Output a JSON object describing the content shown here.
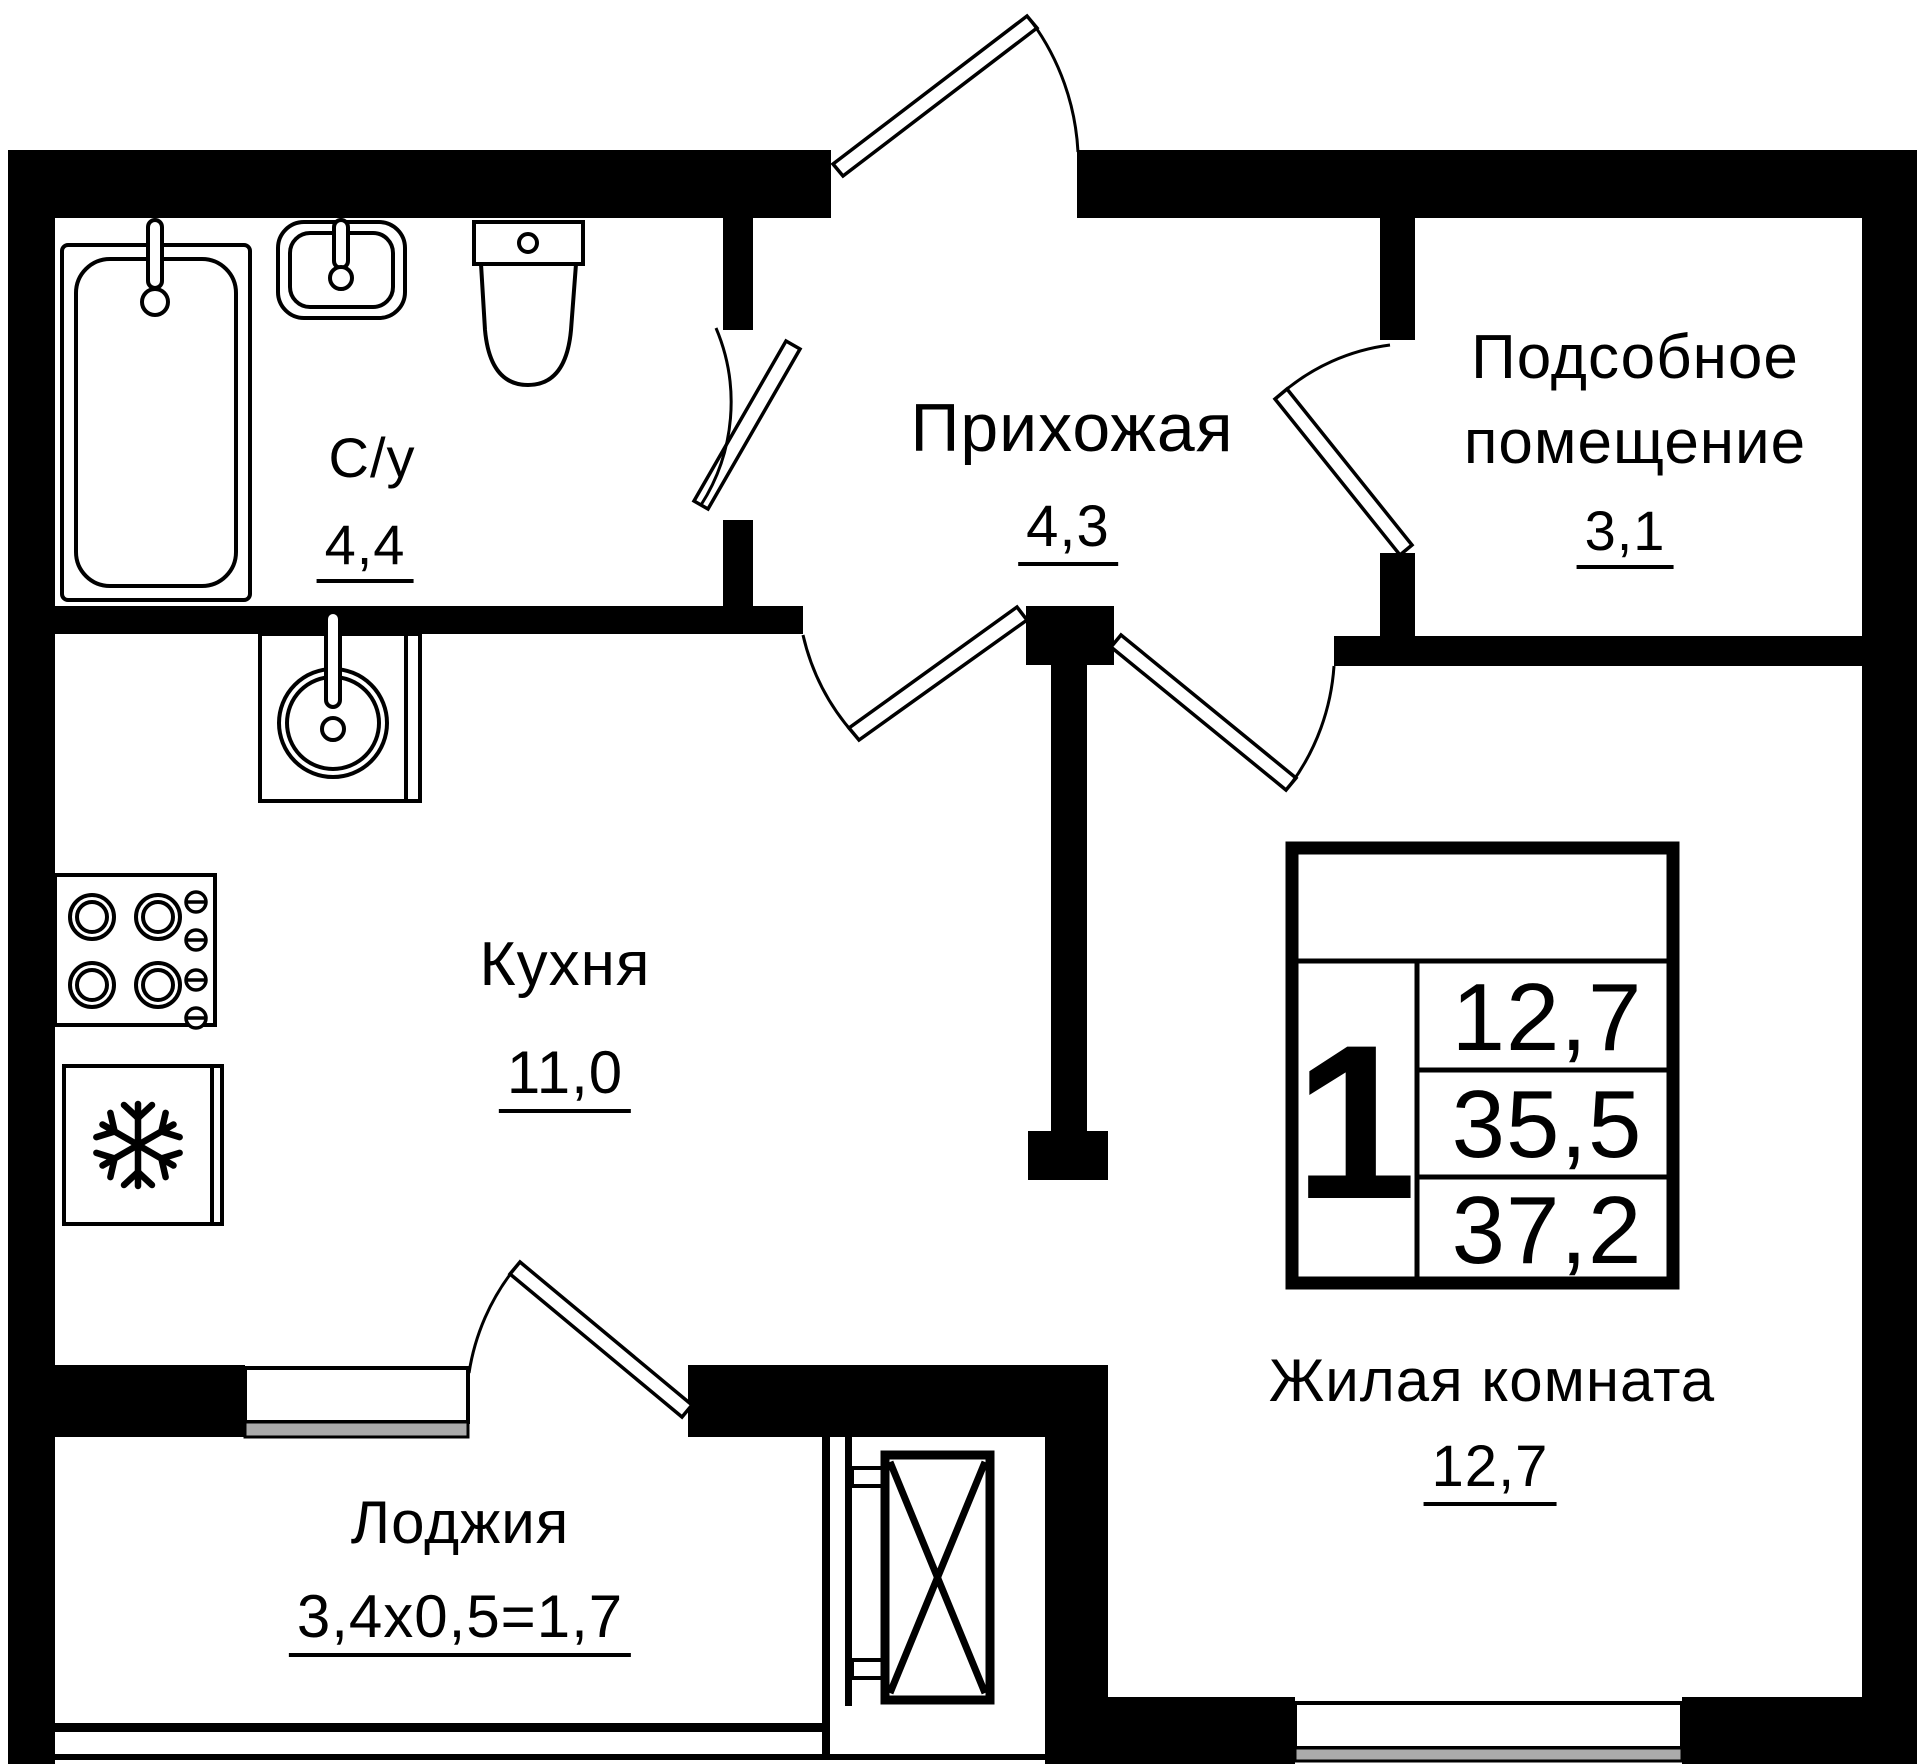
{
  "plan": {
    "rooms": {
      "bathroom": {
        "label": "С/у",
        "area": "4,4"
      },
      "hallway": {
        "label": "Прихожая",
        "area": "4,3"
      },
      "utility": {
        "label_line1": "Подсобное",
        "label_line2": "помещение",
        "area": "3,1"
      },
      "kitchen": {
        "label": "Кухня",
        "area": "11,0"
      },
      "living_room": {
        "label": "Жилая комната",
        "area": "12,7"
      },
      "loggia": {
        "label": "Лоджия",
        "area": "3,4х0,5=1,7"
      }
    },
    "summary_box": {
      "rooms_count": "1",
      "living_area": "12,7",
      "area_without_loggia": "35,5",
      "total_area": "37,2"
    },
    "colors": {
      "walls": "#000000",
      "background": "#ffffff",
      "window_sill": "#ababab"
    }
  }
}
